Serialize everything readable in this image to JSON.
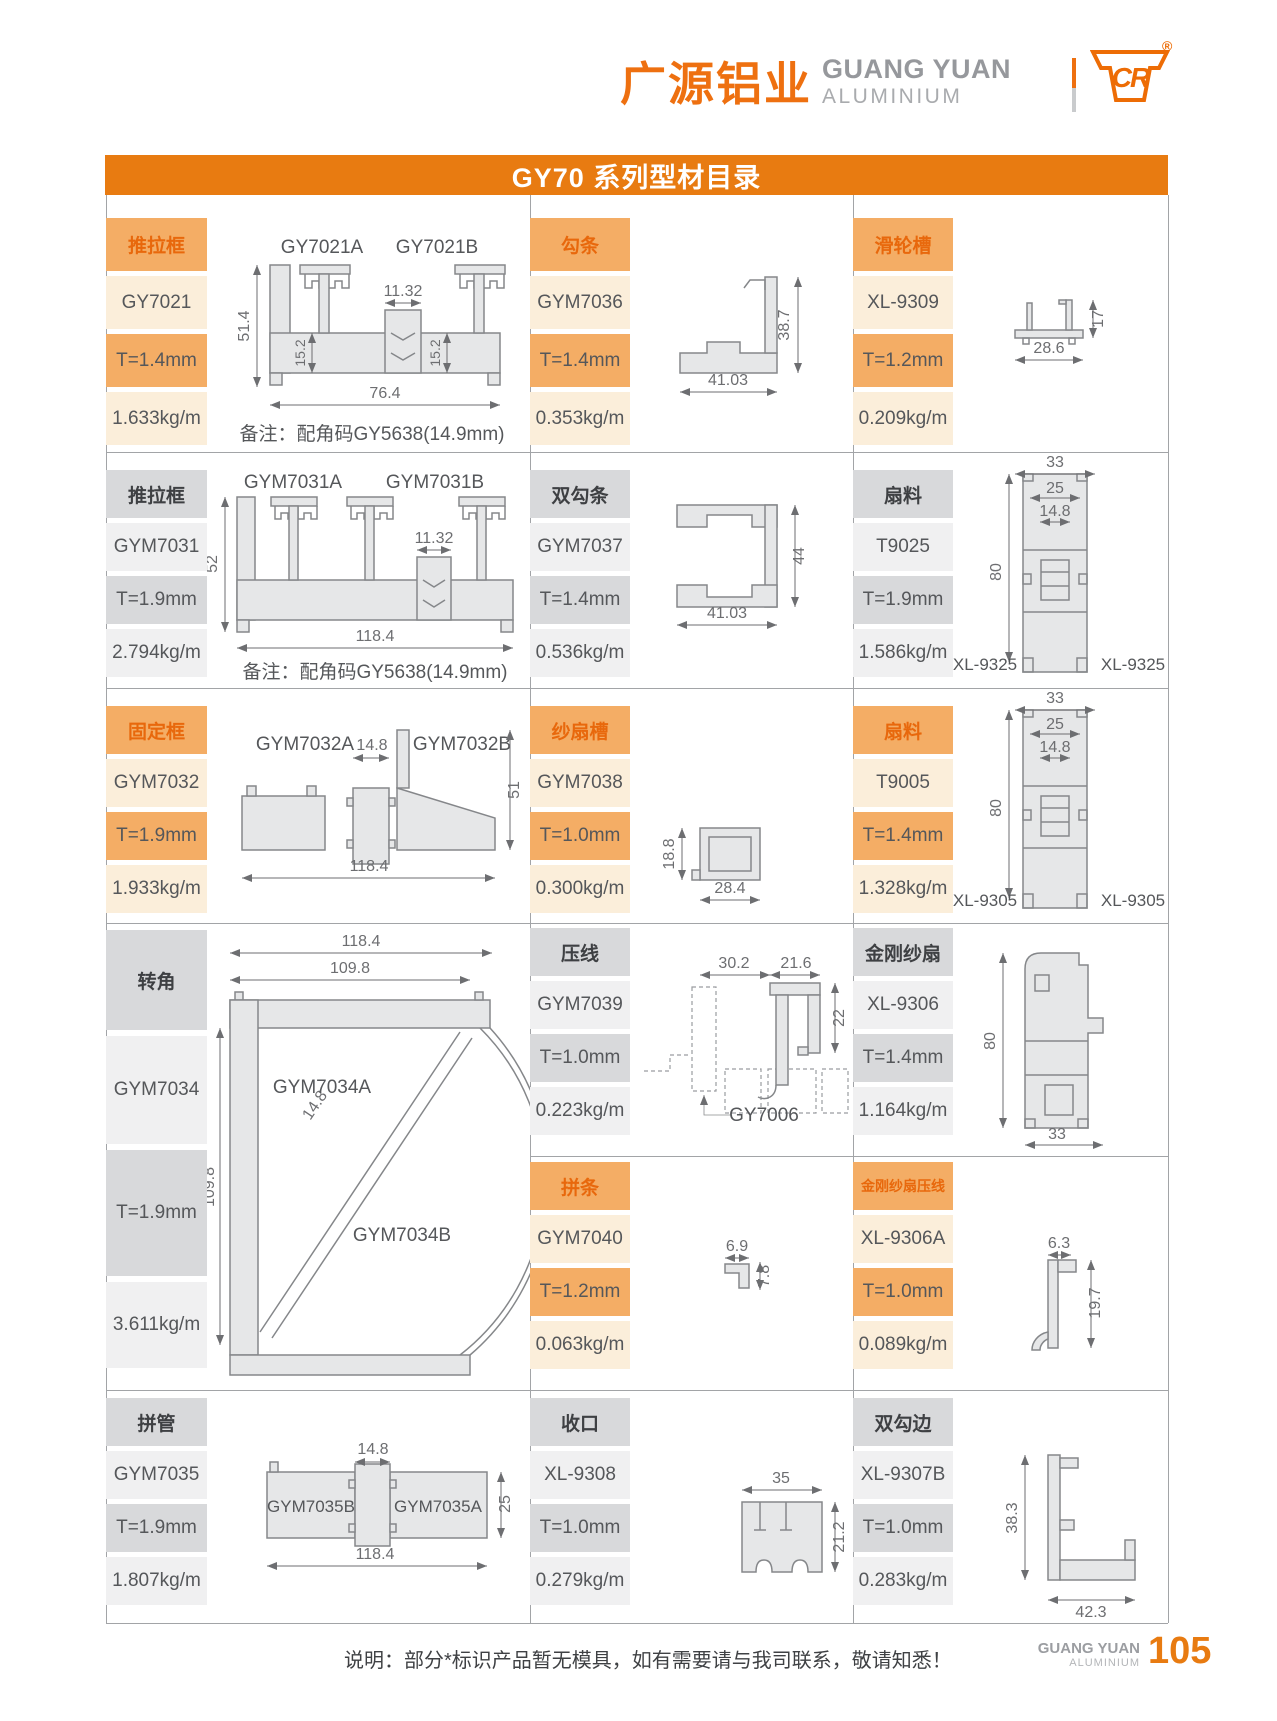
{
  "header": {
    "brand_cn": "广源铝业",
    "brand_en_line1": "GUANG YUAN",
    "brand_en_line2": "ALUMINIUM",
    "logo_text": "CR",
    "registered_mark": "®"
  },
  "title_bar": {
    "text": "GY70 系列型材目录"
  },
  "colors": {
    "accent_orange": "#E87B11",
    "brand_orange": "#EE7010",
    "cell_orange": "#F4AD65",
    "cell_orange_light": "#FBEEDA",
    "cell_gray": "#D8D9DB",
    "cell_gray_light": "#F0F0F1"
  },
  "products": [
    {
      "category": "推拉框",
      "model": "GY7021",
      "thickness": "T=1.4mm",
      "weight": "1.633kg/m",
      "theme": "orange"
    },
    {
      "category": "勾条",
      "model": "GYM7036",
      "thickness": "T=1.4mm",
      "weight": "0.353kg/m",
      "theme": "orange"
    },
    {
      "category": "滑轮槽",
      "model": "XL-9309",
      "thickness": "T=1.2mm",
      "weight": "0.209kg/m",
      "theme": "orange"
    },
    {
      "category": "推拉框",
      "model": "GYM7031",
      "thickness": "T=1.9mm",
      "weight": "2.794kg/m",
      "theme": "gray"
    },
    {
      "category": "双勾条",
      "model": "GYM7037",
      "thickness": "T=1.4mm",
      "weight": "0.536kg/m",
      "theme": "gray"
    },
    {
      "category": "扇料",
      "model": "T9025",
      "thickness": "T=1.9mm",
      "weight": "1.586kg/m",
      "theme": "gray"
    },
    {
      "category": "固定框",
      "model": "GYM7032",
      "thickness": "T=1.9mm",
      "weight": "1.933kg/m",
      "theme": "orange"
    },
    {
      "category": "纱扇槽",
      "model": "GYM7038",
      "thickness": "T=1.0mm",
      "weight": "0.300kg/m",
      "theme": "orange"
    },
    {
      "category": "扇料",
      "model": "T9005",
      "thickness": "T=1.4mm",
      "weight": "1.328kg/m",
      "theme": "orange"
    },
    {
      "category": "转角",
      "model": "GYM7034",
      "thickness": "T=1.9mm",
      "weight": "3.611kg/m",
      "theme": "gray"
    },
    {
      "category": "压线",
      "model": "GYM7039",
      "thickness": "T=1.0mm",
      "weight": "0.223kg/m",
      "theme": "gray"
    },
    {
      "category": "金刚纱扇",
      "model": "XL-9306",
      "thickness": "T=1.4mm",
      "weight": "1.164kg/m",
      "theme": "gray"
    },
    {
      "category": "拼条",
      "model": "GYM7040",
      "thickness": "T=1.2mm",
      "weight": "0.063kg/m",
      "theme": "orange"
    },
    {
      "category": "金刚纱扇压线",
      "model": "XL-9306A",
      "thickness": "T=1.0mm",
      "weight": "0.089kg/m",
      "theme": "orange"
    },
    {
      "category": "拼管",
      "model": "GYM7035",
      "thickness": "T=1.9mm",
      "weight": "1.807kg/m",
      "theme": "gray"
    },
    {
      "category": "收口",
      "model": "XL-9308",
      "thickness": "T=1.0mm",
      "weight": "0.279kg/m",
      "theme": "gray"
    },
    {
      "category": "双勾边",
      "model": "XL-9307B",
      "thickness": "T=1.0mm",
      "weight": "0.283kg/m",
      "theme": "gray"
    }
  ],
  "drawings": {
    "gy7021": {
      "label_a": "GY7021A",
      "label_b": "GY7021B",
      "dim_height": "51.4",
      "dim_mid": "11.32",
      "dim_inner_left": "15.2",
      "dim_inner_right": "15.2",
      "dim_width": "76.4",
      "note": "备注：配角码GY5638(14.9mm)"
    },
    "gym7036": {
      "dim_height": "38.7",
      "dim_width": "41.03"
    },
    "xl9309": {
      "dim_height": "17",
      "dim_width": "28.6"
    },
    "gym7031": {
      "label_a": "GYM7031A",
      "label_b": "GYM7031B",
      "dim_height": "52",
      "dim_mid": "11.32",
      "dim_width": "118.4",
      "note": "备注：配角码GY5638(14.9mm)"
    },
    "gym7037": {
      "dim_height": "44",
      "dim_width": "41.03"
    },
    "t9025": {
      "dim_w1": "33",
      "dim_w2": "25",
      "dim_w3": "14.8",
      "dim_height": "80",
      "side_left": "XL-9325",
      "side_right": "XL-9325"
    },
    "gym7032": {
      "label_a": "GYM7032A",
      "dim_mid": "14.8",
      "label_b": "GYM7032B",
      "dim_height": "51",
      "dim_width": "118.4"
    },
    "gym7038": {
      "dim_height": "18.8",
      "dim_width": "28.4"
    },
    "t9005": {
      "dim_w1": "33",
      "dim_w2": "25",
      "dim_w3": "14.8",
      "dim_height": "80",
      "side_left": "XL-9305",
      "side_right": "XL-9305"
    },
    "gym7034": {
      "dim_w1": "118.4",
      "dim_w2": "109.8",
      "label_a": "GYM7034A",
      "label_b": "GYM7034B",
      "dim_height": "109.8",
      "dim_mid": "14.8"
    },
    "gym7039": {
      "dim_w1": "30.2",
      "dim_w2": "21.6",
      "dim_height": "22",
      "ref_label": "GY7006"
    },
    "gym7040": {
      "dim_width": "6.9",
      "dim_height": "7.8"
    },
    "xl9306": {
      "dim_height": "80",
      "dim_width": "33"
    },
    "xl9306a": {
      "dim_width": "6.3",
      "dim_height": "19.7"
    },
    "gym7035": {
      "dim_mid": "14.8",
      "label_b": "GYM7035B",
      "label_a": "GYM7035A",
      "dim_height": "25",
      "dim_width": "118.4"
    },
    "xl9308": {
      "dim_width": "35",
      "dim_height": "21.2"
    },
    "xl9307b": {
      "dim_height": "38.3",
      "dim_width": "42.3"
    }
  },
  "footer": {
    "note": "说明：部分*标识产品暂无模具，如有需要请与我司联系，敬请知悉！",
    "brand_en_line1": "GUANG YUAN",
    "brand_en_line2": "ALUMINIUM",
    "page_number": "105"
  }
}
